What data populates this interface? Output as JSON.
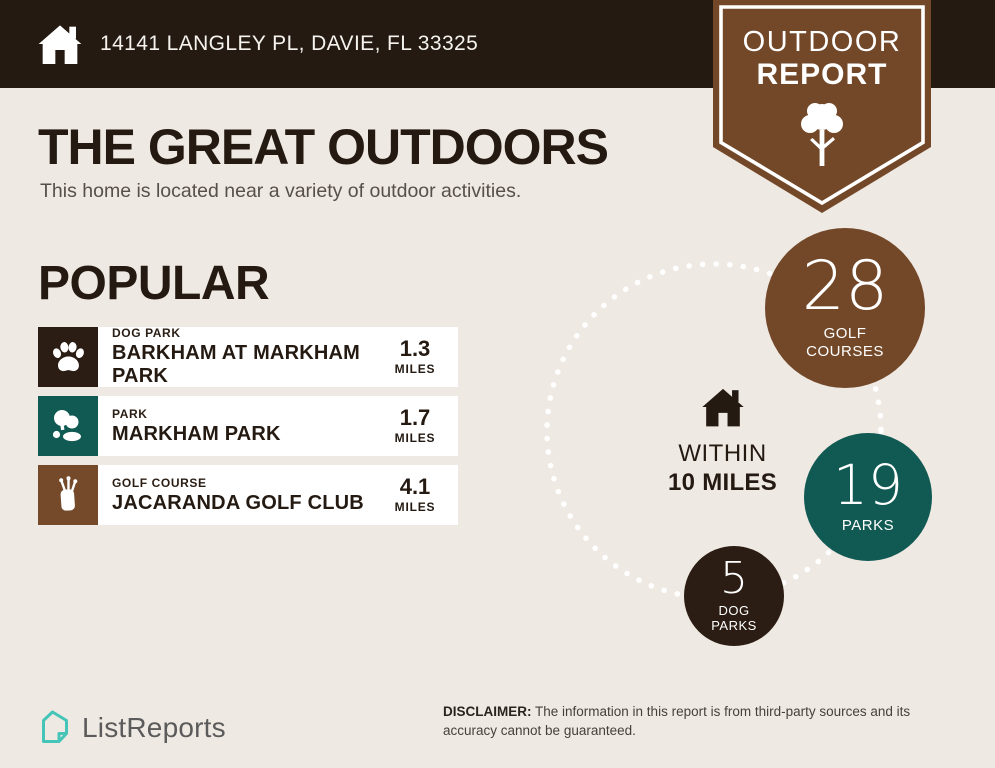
{
  "header": {
    "address": "14141 LANGLEY PL, DAVIE, FL 33325"
  },
  "badge": {
    "line1": "OUTDOOR",
    "line2": "REPORT"
  },
  "main": {
    "title": "THE GREAT OUTDOORS",
    "subtitle": "This home is located near a variety of outdoor activities.",
    "section_title": "POPULAR"
  },
  "popular": {
    "items": [
      {
        "category": "DOG PARK",
        "name": "BARKHAM AT MARKHAM PARK",
        "distance": "1.3",
        "unit": "MILES",
        "icon": "paw-icon",
        "tile_color": "#2b1d13"
      },
      {
        "category": "PARK",
        "name": "MARKHAM PARK",
        "distance": "1.7",
        "unit": "MILES",
        "icon": "park-trees-icon",
        "tile_color": "#115a53"
      },
      {
        "category": "GOLF COURSE",
        "name": "JACARANDA GOLF CLUB",
        "distance": "4.1",
        "unit": "MILES",
        "icon": "golf-bag-icon",
        "tile_color": "#754a2b"
      }
    ]
  },
  "radius": {
    "within_line1": "WITHIN",
    "within_line2": "10 MILES",
    "stats": [
      {
        "value": "28",
        "label": "GOLF COURSES",
        "color": "#734829"
      },
      {
        "value": "19",
        "label": "PARKS",
        "color": "#115a53"
      },
      {
        "value": "5",
        "label": "DOG PARKS",
        "color": "#2b1d13"
      }
    ]
  },
  "footer": {
    "brand": "ListReports",
    "disclaimer_label": "DISCLAIMER:",
    "disclaimer_text": " The information in this report is from third-party sources and its accuracy cannot be guaranteed."
  },
  "colors": {
    "header_bg": "#241a12",
    "page_bg": "#efe9e3",
    "badge_brown": "#734829",
    "teal": "#115a53",
    "dark_brown": "#2b1d13",
    "brand_teal": "#45c4b8",
    "ring_dots": "#ffffff"
  }
}
